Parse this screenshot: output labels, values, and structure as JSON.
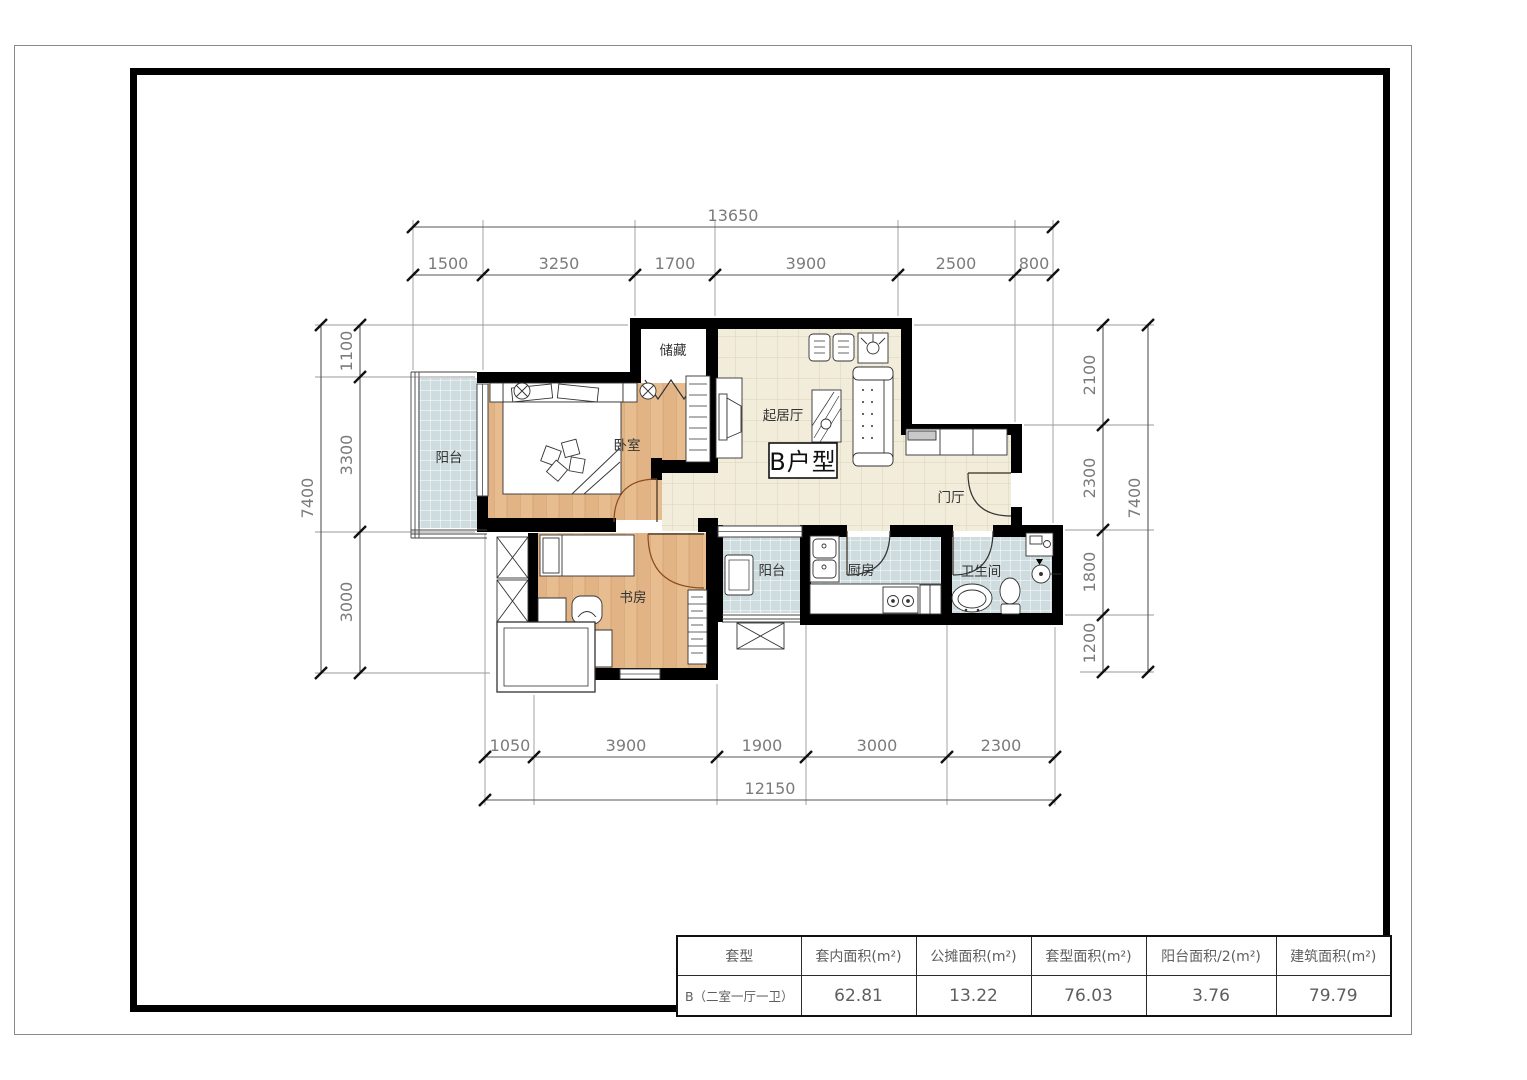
{
  "sheet": {
    "unit_label": "B户型"
  },
  "rooms": {
    "storage": "储藏",
    "living": "起居厅",
    "bedroom": "卧室",
    "balcony_left": "阳台",
    "study": "书房",
    "balcony_service": "阳台",
    "kitchen": "厨房",
    "bathroom": "卫生间",
    "foyer": "门厅"
  },
  "dimensions": {
    "top": {
      "total": "13650",
      "segments": [
        "1500",
        "3250",
        "1700",
        "3900",
        "2500",
        "800"
      ]
    },
    "bottom": {
      "total": "12150",
      "segments": [
        "1050",
        "3900",
        "1900",
        "3000",
        "2300"
      ]
    },
    "left": {
      "total": "7400",
      "segments": [
        "1100",
        "3300",
        "3000"
      ]
    },
    "right": {
      "total": "7400",
      "segments": [
        "2100",
        "2300",
        "1800",
        "1200"
      ]
    }
  },
  "table": {
    "headers": [
      "套型",
      "套内面积(m²)",
      "公摊面积(m²)",
      "套型面积(m²)",
      "阳台面积/2(m²)",
      "建筑面积(m²)"
    ],
    "row": [
      "B（二室一厅一卫）",
      "62.81",
      "13.22",
      "76.03",
      "3.76",
      "79.79"
    ]
  },
  "colors": {
    "wall": "#000000",
    "wood_floor": "#e7bd8f",
    "tile_cream": "#f2ecda",
    "tile_blue": "#cedbdf"
  }
}
